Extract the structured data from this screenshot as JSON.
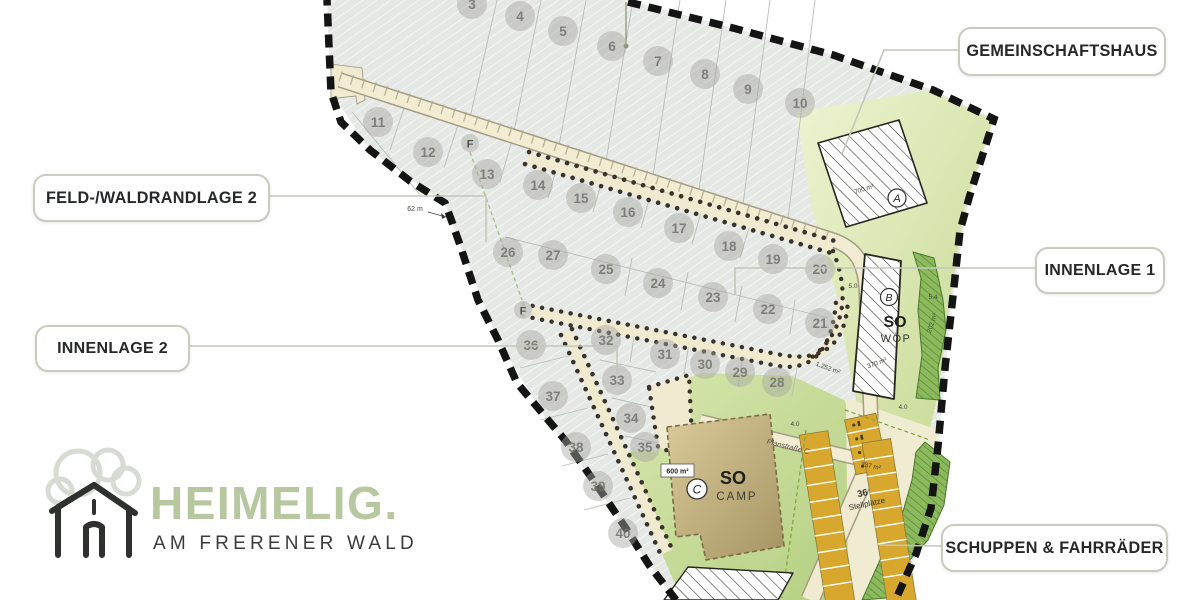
{
  "callouts": {
    "gemeinschaftshaus": "GEMEINSCHAFTSHAUS",
    "feldwaldrandlage2": "FELD-/WALDRANDLAGE 2",
    "innenlage1": "INNENLAGE 1",
    "innenlage2": "INNENLAGE 2",
    "schuppen_fahrraeder": "SCHUPPEN & FAHRRÄDER"
  },
  "logo": {
    "name": "HEIMELIG.",
    "tagline": "AM FRERENER WALD"
  },
  "plan": {
    "zones": {
      "woep_code": "SO",
      "woep_name": "WÖP",
      "camp_code": "SO",
      "camp_name": "CAMP",
      "building_a": "A",
      "building_b": "B",
      "building_c": "C",
      "hydrant": "F",
      "parking_count": "36",
      "parking_label": "Stellplätze",
      "street": "Planstraße C"
    },
    "areas": {
      "building_a": "700 m²",
      "building_b": "370 m²",
      "camp": "600 m²",
      "road": "1.252 m²",
      "parking": "337 m²",
      "greenstrip": "202 m²",
      "edge_length": "62 m"
    },
    "dims": [
      {
        "t": "4.0",
        "x": 903,
        "y": 409,
        "r": 0
      },
      {
        "t": "4.0",
        "x": 795,
        "y": 426,
        "r": 0
      },
      {
        "t": "5.0",
        "x": 853,
        "y": 288,
        "r": 0
      },
      {
        "t": "5.4",
        "x": 933,
        "y": 299,
        "r": 0
      }
    ],
    "lots": [
      {
        "n": "3",
        "x": 472,
        "y": 4
      },
      {
        "n": "4",
        "x": 520,
        "y": 16
      },
      {
        "n": "5",
        "x": 563,
        "y": 31
      },
      {
        "n": "6",
        "x": 612,
        "y": 46
      },
      {
        "n": "7",
        "x": 658,
        "y": 61
      },
      {
        "n": "8",
        "x": 705,
        "y": 74
      },
      {
        "n": "9",
        "x": 748,
        "y": 89
      },
      {
        "n": "10",
        "x": 800,
        "y": 103
      },
      {
        "n": "11",
        "x": 378,
        "y": 122
      },
      {
        "n": "12",
        "x": 428,
        "y": 152
      },
      {
        "n": "13",
        "x": 487,
        "y": 174
      },
      {
        "n": "14",
        "x": 538,
        "y": 185
      },
      {
        "n": "15",
        "x": 581,
        "y": 198
      },
      {
        "n": "16",
        "x": 628,
        "y": 212
      },
      {
        "n": "17",
        "x": 679,
        "y": 228
      },
      {
        "n": "18",
        "x": 729,
        "y": 246
      },
      {
        "n": "19",
        "x": 773,
        "y": 259
      },
      {
        "n": "20",
        "x": 820,
        "y": 269
      },
      {
        "n": "21",
        "x": 820,
        "y": 323
      },
      {
        "n": "22",
        "x": 768,
        "y": 309
      },
      {
        "n": "23",
        "x": 713,
        "y": 297
      },
      {
        "n": "24",
        "x": 658,
        "y": 283
      },
      {
        "n": "25",
        "x": 606,
        "y": 269
      },
      {
        "n": "26",
        "x": 508,
        "y": 252
      },
      {
        "n": "27",
        "x": 553,
        "y": 255
      },
      {
        "n": "28",
        "x": 777,
        "y": 382
      },
      {
        "n": "29",
        "x": 740,
        "y": 372
      },
      {
        "n": "30",
        "x": 705,
        "y": 364
      },
      {
        "n": "31",
        "x": 665,
        "y": 354
      },
      {
        "n": "32",
        "x": 606,
        "y": 340
      },
      {
        "n": "33",
        "x": 617,
        "y": 380
      },
      {
        "n": "34",
        "x": 631,
        "y": 418
      },
      {
        "n": "35",
        "x": 645,
        "y": 447
      },
      {
        "n": "36",
        "x": 531,
        "y": 345
      },
      {
        "n": "37",
        "x": 553,
        "y": 396
      },
      {
        "n": "38",
        "x": 576,
        "y": 447
      },
      {
        "n": "39",
        "x": 598,
        "y": 486
      },
      {
        "n": "40",
        "x": 623,
        "y": 533
      }
    ]
  },
  "colors": {
    "lot_fill": "#e5e8e4",
    "lot_circle": "#a7a7a1",
    "lot_digit": "#73736c",
    "road": "#f2ecd3",
    "road_edge": "#a59d83",
    "dots": "#3a332b",
    "boundary": "#141414",
    "green_strip": "#8bb95c",
    "parking": "#d7a72e",
    "logo_green": "#b7c8a1",
    "callout_border": "#c7ccbe"
  }
}
